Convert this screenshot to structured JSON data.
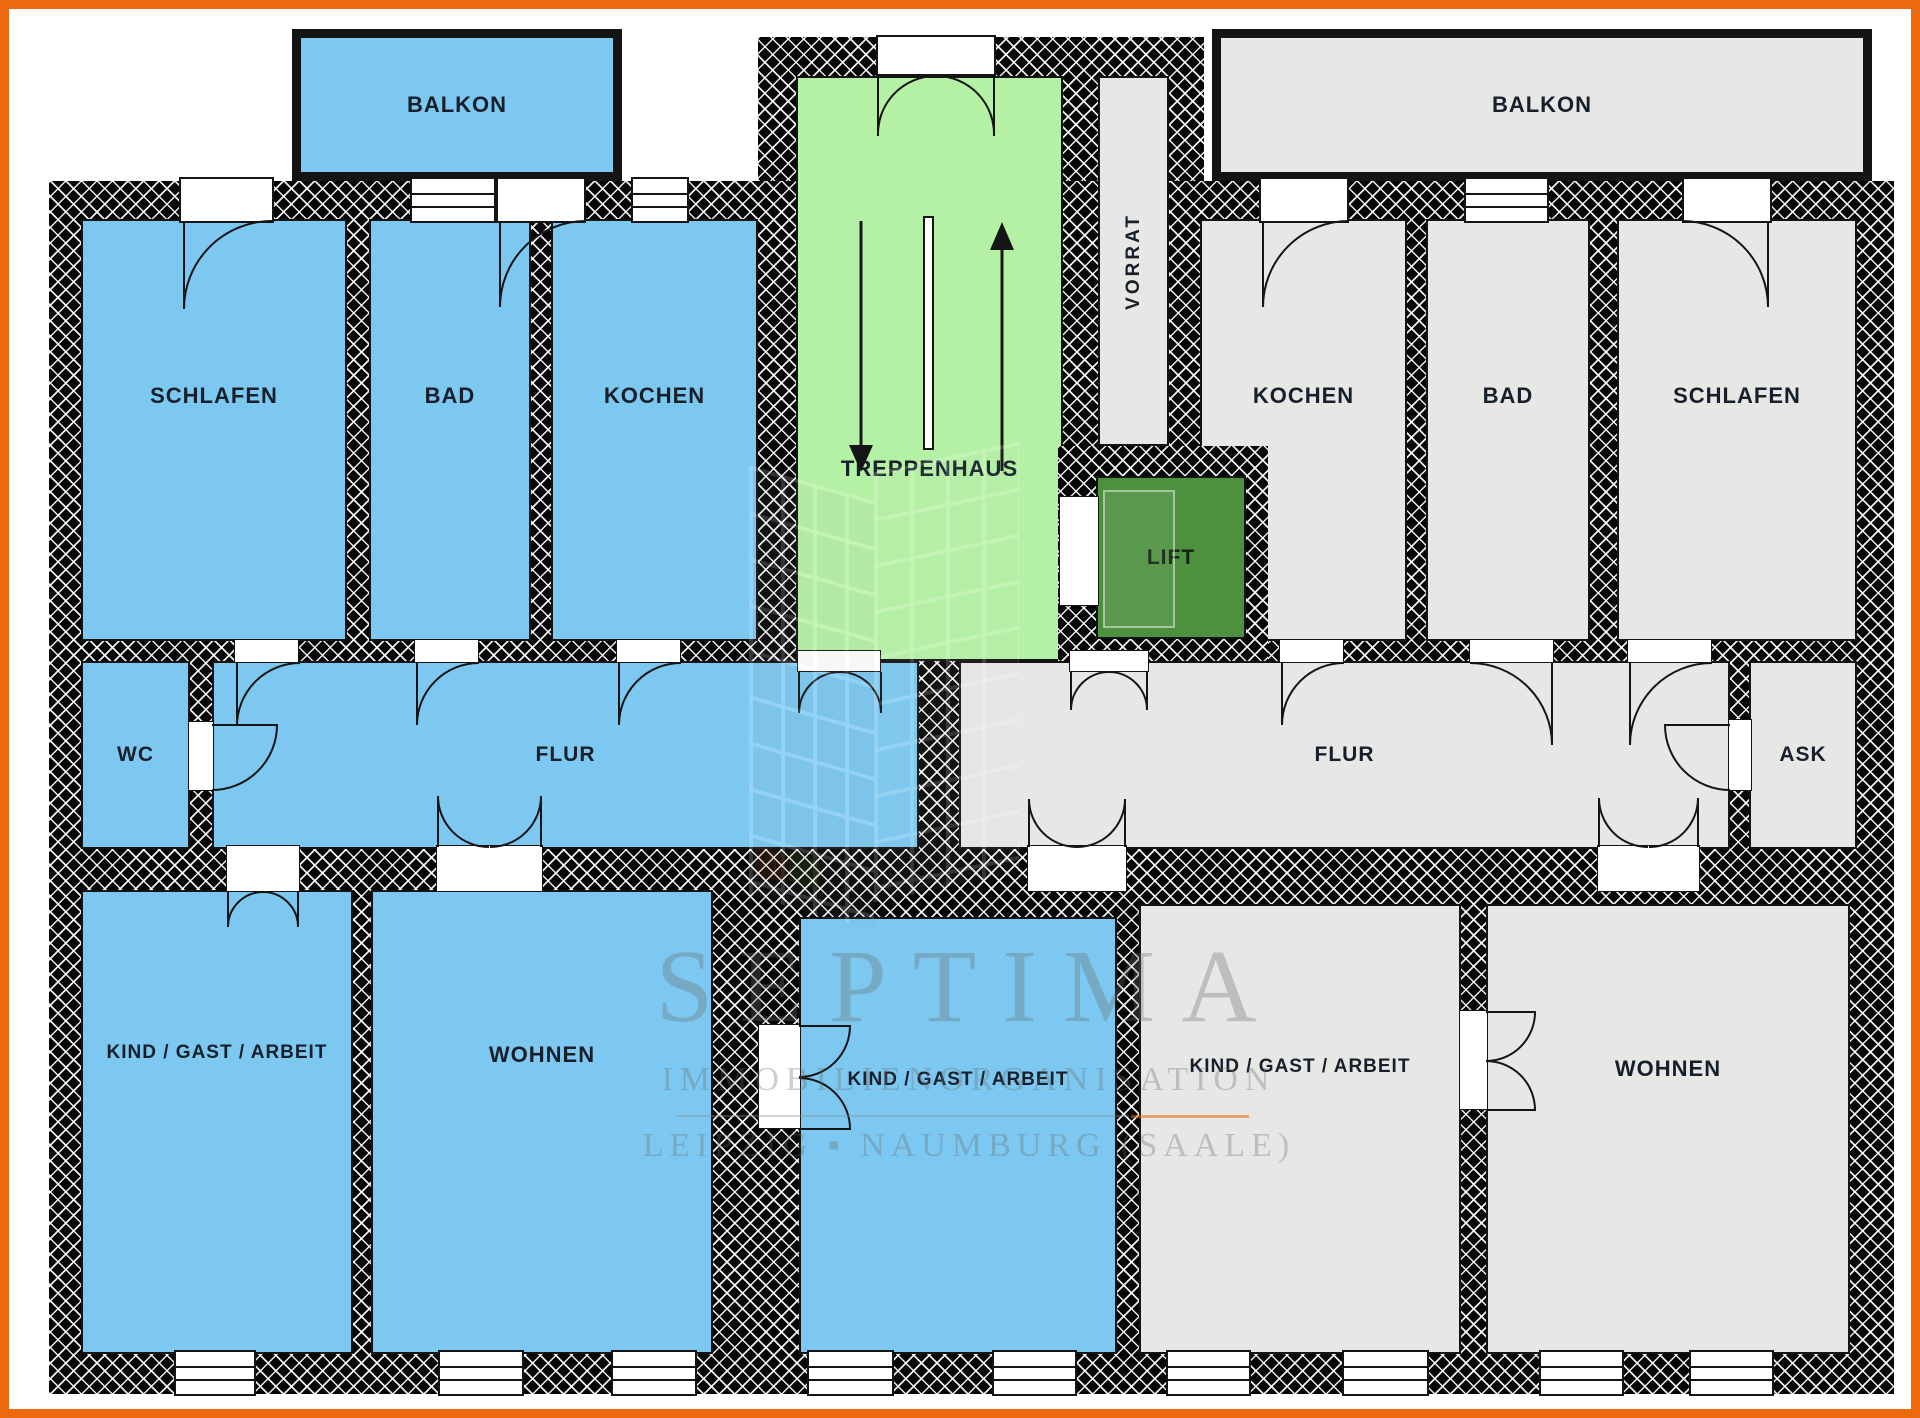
{
  "meta": {
    "type": "floor-plan",
    "description": "Apartment floor plan with two mirrored flats, stairwell and lift"
  },
  "colors": {
    "flat_left": "#7CC8F1",
    "flat_right": "#E7E7E5",
    "stairwell": "#B5F1A4",
    "lift": "#4D9140",
    "wall": "#070707",
    "frame": "#EC6A0D"
  },
  "rooms": [
    {
      "id": "balkon-left",
      "label": "BALKON"
    },
    {
      "id": "schlafen-left",
      "label": "SCHLAFEN"
    },
    {
      "id": "bad-left",
      "label": "BAD"
    },
    {
      "id": "kochen-left",
      "label": "KOCHEN"
    },
    {
      "id": "wc",
      "label": "WC"
    },
    {
      "id": "flur-left",
      "label": "FLUR"
    },
    {
      "id": "kind-left",
      "label": "KIND / GAST / ARBEIT"
    },
    {
      "id": "wohnen-left",
      "label": "WOHNEN"
    },
    {
      "id": "kind-middle",
      "label": "KIND / GAST / ARBEIT"
    },
    {
      "id": "treppenhaus",
      "label": "TREPPENHAUS"
    },
    {
      "id": "lift",
      "label": "LIFT"
    },
    {
      "id": "vorrat",
      "label": "VORRAT"
    },
    {
      "id": "balkon-right",
      "label": "BALKON"
    },
    {
      "id": "kochen-right",
      "label": "KOCHEN"
    },
    {
      "id": "bad-right",
      "label": "BAD"
    },
    {
      "id": "schlafen-right",
      "label": "SCHLAFEN"
    },
    {
      "id": "flur-right",
      "label": "FLUR"
    },
    {
      "id": "ask",
      "label": "ASK"
    },
    {
      "id": "kind-right",
      "label": "KIND / GAST / ARBEIT"
    },
    {
      "id": "wohnen-right",
      "label": "WOHNEN"
    }
  ],
  "watermark": {
    "line1": "SEPTIMA",
    "line2": "IMMOBILIENORGANISATION",
    "line3": "LEIPZIG ▪ NAUMBURG (SAALE)"
  }
}
